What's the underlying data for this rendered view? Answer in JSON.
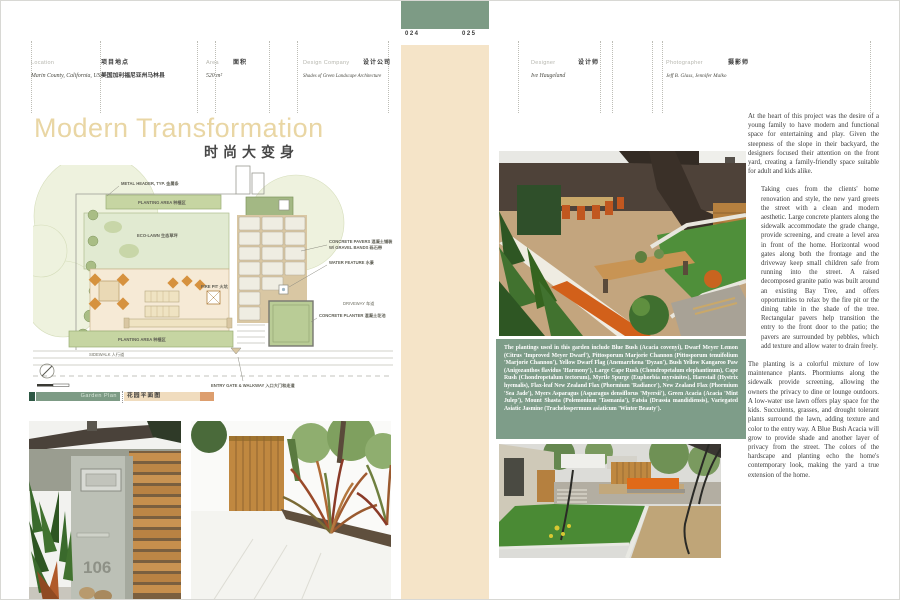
{
  "page": {
    "left_no": "024",
    "right_no": "025"
  },
  "header_left": {
    "location": {
      "label_en": "Location",
      "label_zh": "项目地点",
      "value_en": "Marin County, California, USA",
      "value_zh": "美国加利福尼亚州马林县"
    },
    "area": {
      "label_en": "Area",
      "label_zh": "面积",
      "value": "520 m²"
    },
    "company": {
      "label_en": "Design Company",
      "label_zh": "设计公司",
      "value": "Shades of Green Landscape Architecture"
    }
  },
  "header_right": {
    "designer": {
      "label_en": "Designer",
      "label_zh": "设计师",
      "value": "Ive Haugeland"
    },
    "photographer": {
      "label_en": "Photographer",
      "label_zh": "摄影师",
      "value": "Jeff B. Glass, Jennifer Malko"
    }
  },
  "title": {
    "en": "Modern Transformation",
    "zh": "时尚大变身"
  },
  "garden_bar": {
    "en": "Garden Plan",
    "zh": "花园平面图"
  },
  "plan": {
    "labels": {
      "metal_header": "METAL HEADER, TYP. 金属条",
      "planting_area_top": "PLANTING AREA 种植区",
      "eco_lawn": "ECO-LAWN 生态草坪",
      "pavers_1": "CONCRETE PAVERS 混凝土铺装",
      "pavers_2": "W/ GRAVEL BANDS 砾石带",
      "water": "WATER FEATURE 水景",
      "fire_pit": "FIRE PIT 火坑",
      "planting_area_bottom": "PLANTING AREA 种植区",
      "sidewalk": "SIDEWALK 人行道",
      "driveway": "DRIVEWAY 车道",
      "planter": "CONCRETE PLANTER 混凝土花池",
      "entry": "ENTRY GATE & WALKWAY 入口大门和走道"
    }
  },
  "photos": {
    "house_number": "106"
  },
  "caption": "The plantings used in this garden include Blue Bush (Acacia covenyi), Dwarf Meyer Lemon (Citrus 'Improved Meyer Dwarf'), Pittosporum Marjorie Channon (Pittosporum tenuifolium 'Marjorie Channon'), Yellow Dwarf Flag (Anemarrhena 'Dyzan'), Bush Yellow Kangaroo Paw (Anigozanthos flavidus 'Harmony'), Large Cape Rush (Chondropetalum elephantinum), Cape Rush (Chondropetalum tectorum), Myrtle Spurge (Euphorbia myrsinites), Harestail (Hystrix hyemalis), Flax-leaf New Zealand Flax (Phormium 'Radiance'), New Zealand Flax (Phormium 'Sea Jade'), Myers Asparagus (Asparagus densiflorus 'Myersii'), Green Acacia (Acacia 'Mint Julep'), Mount Shasta (Polemonium 'Tasmania'), Fatsia (Drassia mandidiensis), Variegated Asiatic Jasmine (Trachelospermum asiaticum 'Winter Beauty').",
  "article": {
    "p1": "At the heart of this project was the desire of a young family to have modern and functional space for entertaining and play. Given the steepness of the slope in their backyard, the designers focused their attention on the front yard, creating a family-friendly space suitable for adult and kids alike.",
    "p2": "Taking cues from the clients' home renovation and style, the new yard greets the street with a clean and modern aesthetic. Large concrete planters along the sidewalk accommodate the grade change, provide screening, and create a level area in front of the home. Horizontal wood gates along both the frontage and the driveway keep small children safe from running into the street. A raised decomposed granite patio was built around an existing Bay Tree, and offers opportunities to relax by the fire pit or the dining table in the shade of the tree. Rectangular pavers help transition the entry to the front door to the patio; the pavers are surrounded by pebbles, which add texture and allow water to drain freely.",
    "p3": "The planting is a colorful mixture of low maintenance plants. Phormiums along the sidewalk provide screening, allowing the owners the privacy to dine or lounge outdoors. A low-water use lawn offers play space for the kids. Succulents, grasses, and drought tolerant plants surround the lawn, adding texture and color to the entry way. A Blue Bush Acacia will grow to provide shade and another layer of privacy from the street. The colors of the hardscape and planting echo the home's contemporary look, making the yard a true extension of the home."
  }
}
